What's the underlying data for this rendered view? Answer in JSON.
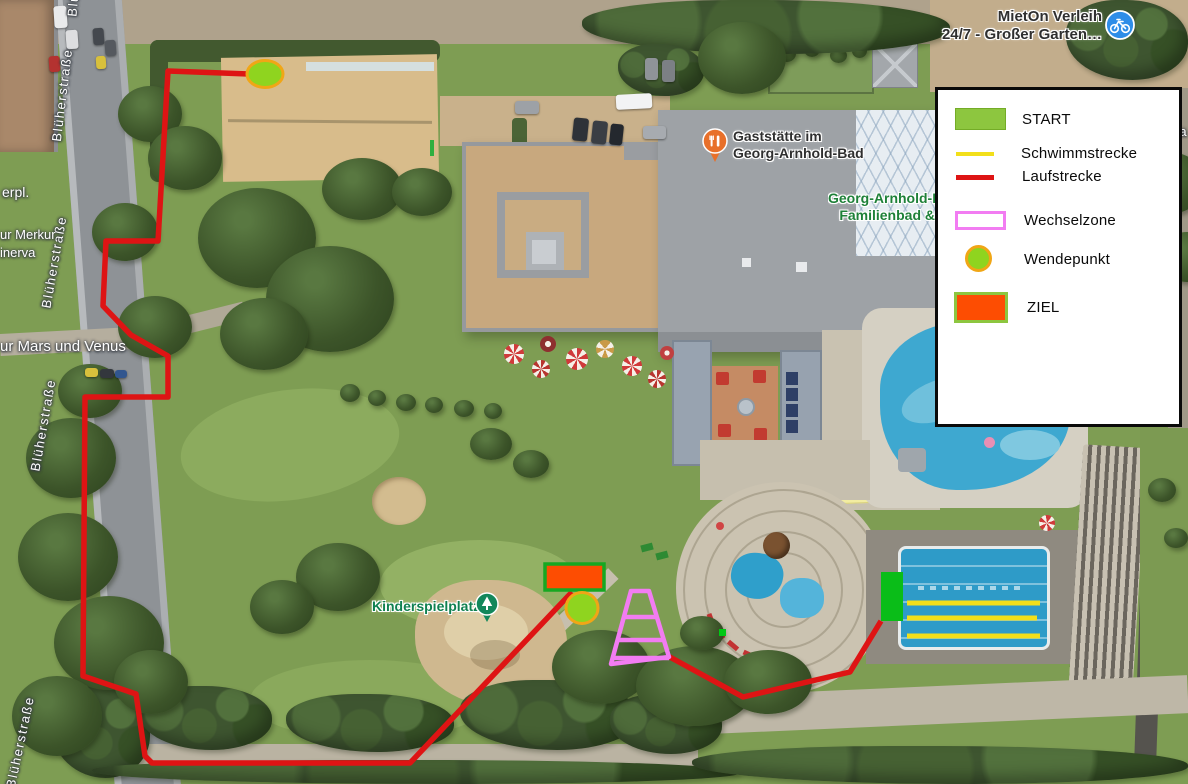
{
  "colors": {
    "laufstrecke": "#DE1414",
    "schwimmstrecke": "#F2DF1A",
    "wechselzone": "#F27CF2",
    "wendepunkt_fill": "#8FD41F",
    "wendepunkt_border": "#F0A616",
    "ziel_fill": "#FD4D02",
    "ziel_border": "#16A822",
    "start_marker": "#0ABD18",
    "legend_start": "#8DC63F",
    "small_marker": "#00C814",
    "poi_green": "#1E8038",
    "playground_green": "#0F8050",
    "street_white": "#FFFFFF",
    "dark_label": "#2F2F2F"
  },
  "legend": {
    "items": [
      {
        "label": "START",
        "swatch": "green-rect"
      },
      {
        "label": "Schwimmstrecke",
        "swatch": "yellow-line"
      },
      {
        "label": "Laufstrecke",
        "swatch": "red-line"
      },
      {
        "label": "Wechselzone",
        "swatch": "pink-outline-rect"
      },
      {
        "label": "Wendepunkt",
        "swatch": "green-circle-orange-border"
      },
      {
        "label": "ZIEL",
        "swatch": "orange-rect-green-border"
      }
    ]
  },
  "labels": {
    "street": "Blüherstraße",
    "erpl": "erpl.",
    "merkur": "ur Merkur",
    "minerva": "inerva",
    "mars_venus": "ur Mars und Venus",
    "ra": "ra",
    "gaststaette_1": "Gaststätte im",
    "gaststaette_2": "Georg-Arnhold-Bad",
    "bad_1": "Georg-Arnhold-B",
    "bad_2": "Familienbad &",
    "kinderspielplatz": "Kinderspielplatz",
    "mieton_1": "MietOn Verleih",
    "mieton_2": "24/7 - Großer Garten…"
  },
  "routes": {
    "laufstrecke_main": "249,74 168,71 158,241 106,241 103,306 131,335 168,356 168,397 85,397 83,676 136,694 145,756 152,763 410,763 572,592",
    "laufstrecke_finish": "668,656 743,697 850,672 881,621",
    "schwimm_1": "907,603 1040,603",
    "schwimm_2": "907,618 1037,618",
    "schwimm_3": "907,636 1040,636",
    "wechselzone_outline": "631,591 649,591 669,657 611,664",
    "wechselzone_rung_1": "624,617 657,617",
    "wechselzone_rung_2": "618,640 664,640",
    "wechselzone_rung_3": "613,658 669,658",
    "start_rect": "881,572 903,572 903,621 881,621",
    "ziel_rect": "545,564 604,564 604,590 545,590",
    "small_marker_rect": "719,629 726,629 726,636 719,636",
    "wendepunkt_top": {
      "cx": 265,
      "cy": 74,
      "rx": 18,
      "ry": 13.5
    },
    "wendepunkt_bottom": {
      "cx": 582,
      "cy": 608,
      "rx": 16,
      "ry": 15.5
    }
  }
}
